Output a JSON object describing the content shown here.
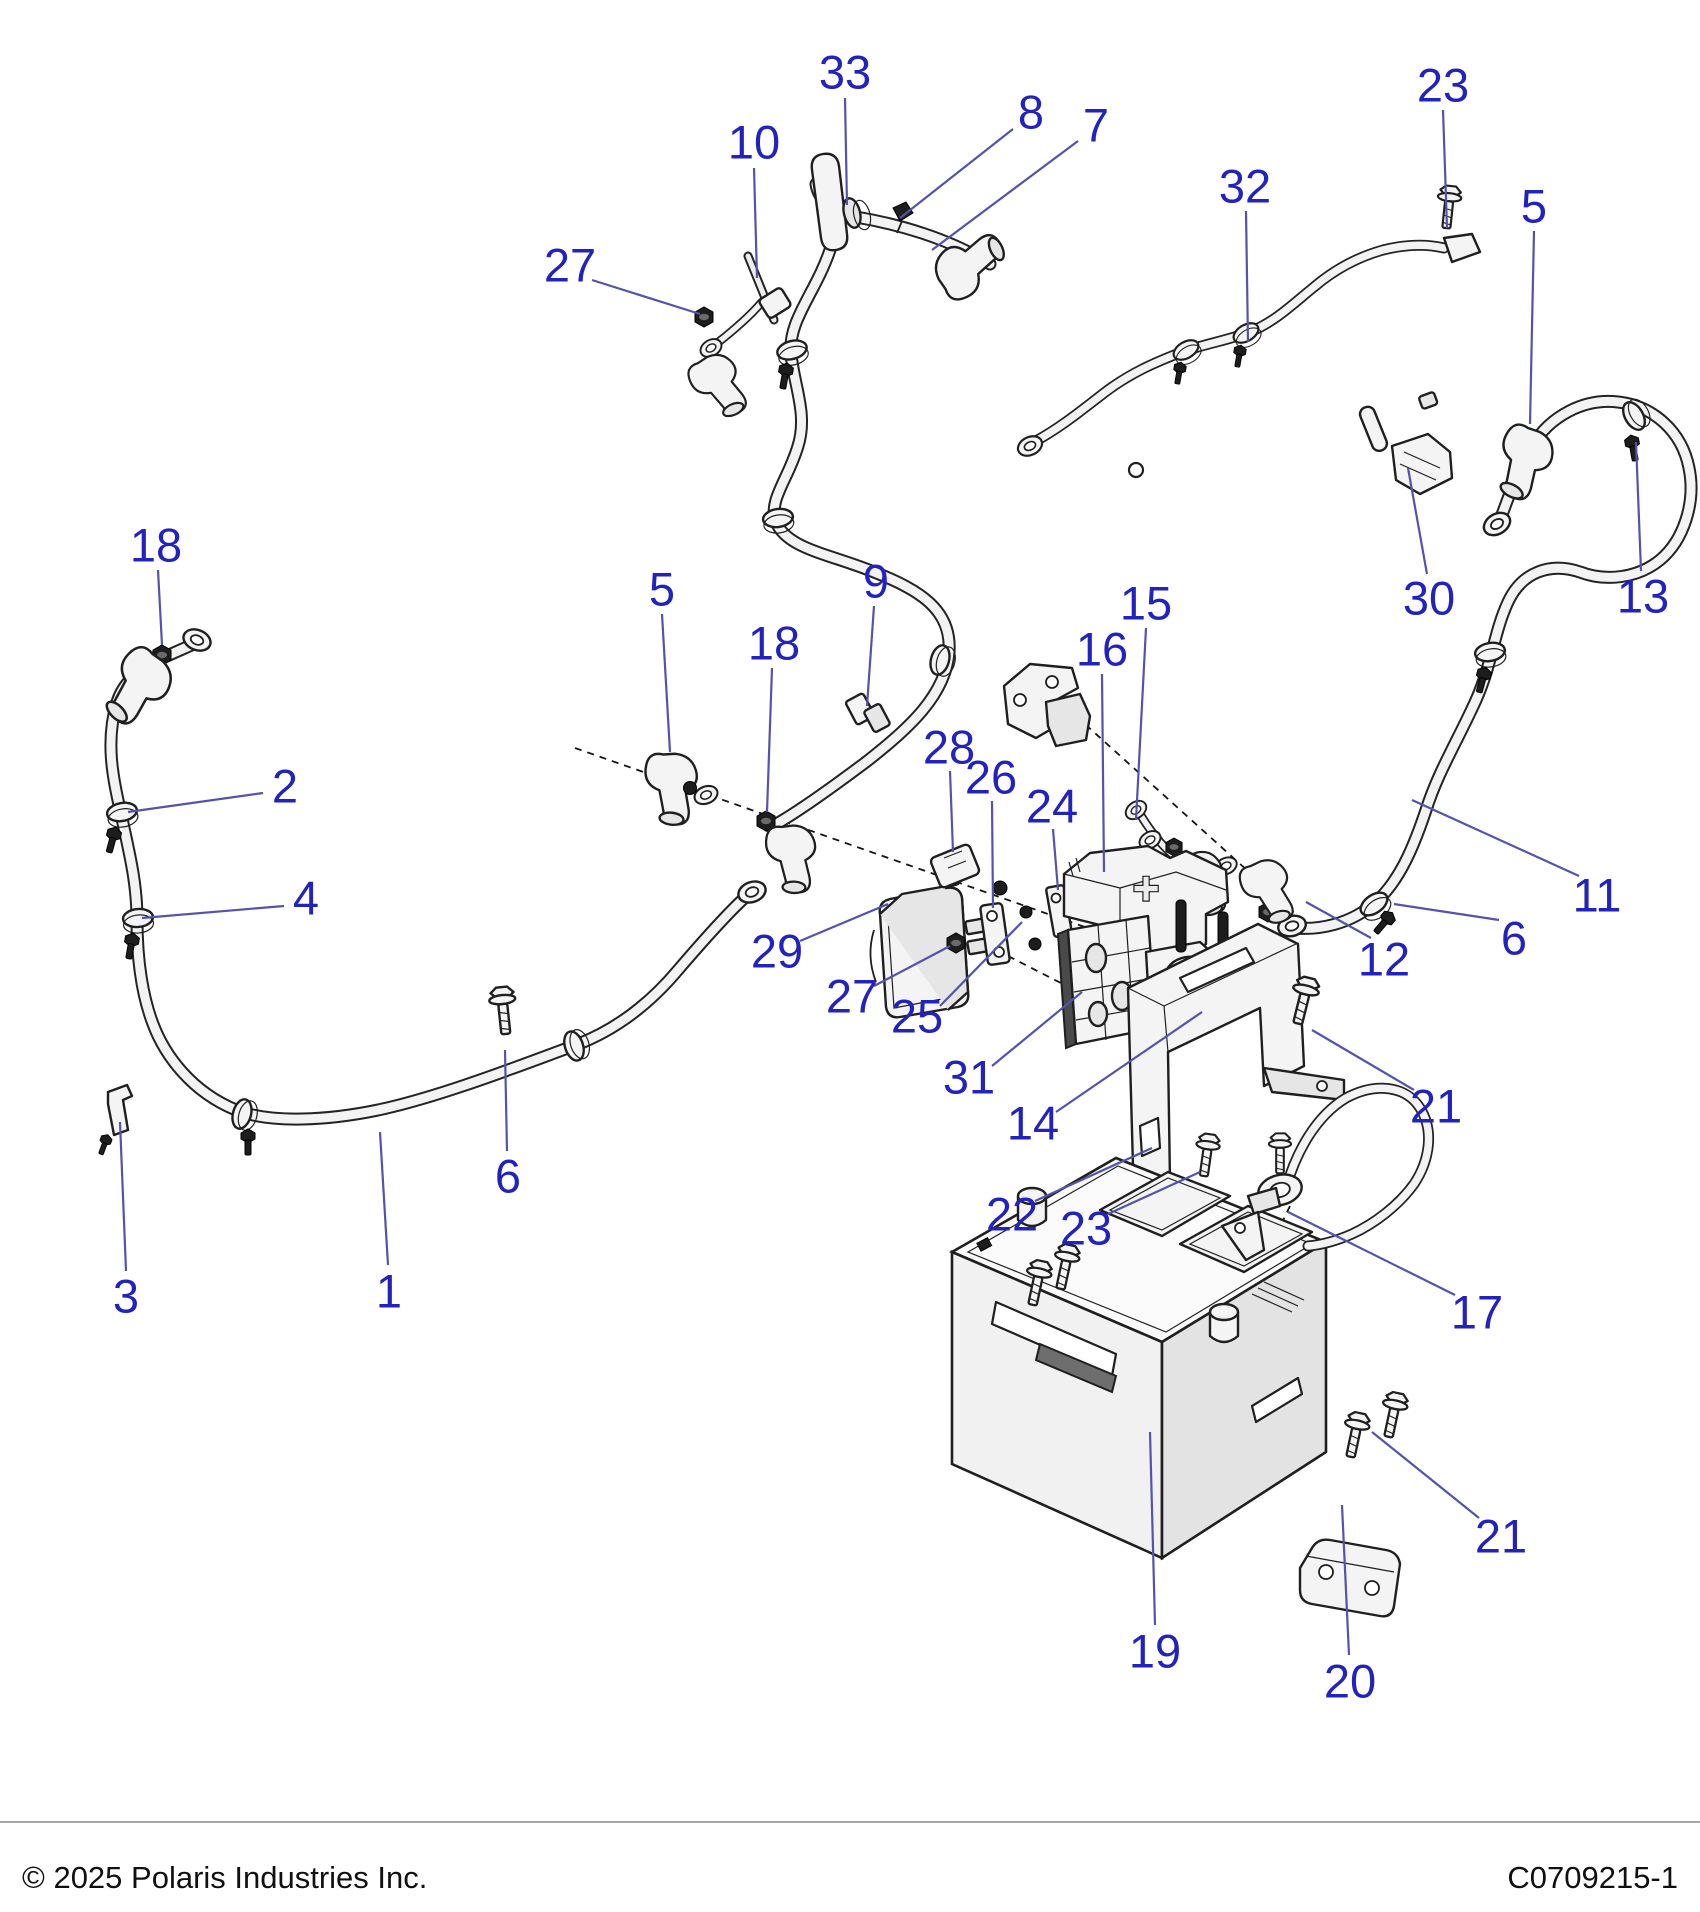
{
  "footer": {
    "copyright": "© 2025 Polaris Industries Inc.",
    "document_code": "C0709215-1"
  },
  "colors": {
    "callout_blue": "#2222bd",
    "leader_blue": "#5353ae",
    "line_black": "#1f1f1f",
    "part_fill": "#f4f4f4",
    "background": "#ffffff"
  },
  "parts": {
    "battery_cover_symbol": "+"
  },
  "callouts": [
    {
      "ref": "33",
      "x": 845,
      "y": 72,
      "leader": [
        845,
        98,
        847,
        205
      ]
    },
    {
      "ref": "10",
      "x": 754,
      "y": 142,
      "leader": [
        754,
        168,
        757,
        278
      ]
    },
    {
      "ref": "8",
      "x": 1031,
      "y": 112,
      "leader": [
        1013,
        129,
        900,
        218
      ]
    },
    {
      "ref": "7",
      "x": 1096,
      "y": 125,
      "leader": [
        1078,
        141,
        932,
        250
      ]
    },
    {
      "ref": "27",
      "x": 570,
      "y": 265,
      "leader": [
        592,
        280,
        700,
        314
      ]
    },
    {
      "ref": "23",
      "x": 1443,
      "y": 85,
      "leader": [
        1443,
        110,
        1447,
        228
      ]
    },
    {
      "ref": "32",
      "x": 1245,
      "y": 186,
      "leader": [
        1246,
        211,
        1248,
        342
      ]
    },
    {
      "ref": "5",
      "x": 1534,
      "y": 206,
      "leader": [
        1534,
        231,
        1530,
        424
      ]
    },
    {
      "ref": "18",
      "x": 156,
      "y": 545,
      "leader": [
        158,
        570,
        162,
        645
      ]
    },
    {
      "ref": "5",
      "x": 662,
      "y": 589,
      "leader": [
        662,
        614,
        670,
        752
      ]
    },
    {
      "ref": "9",
      "x": 876,
      "y": 581,
      "leader": [
        874,
        606,
        867,
        706
      ]
    },
    {
      "ref": "18",
      "x": 774,
      "y": 643,
      "leader": [
        772,
        668,
        767,
        812
      ]
    },
    {
      "ref": "15",
      "x": 1146,
      "y": 603,
      "leader": [
        1146,
        628,
        1136,
        820
      ]
    },
    {
      "ref": "16",
      "x": 1102,
      "y": 649,
      "leader": [
        1102,
        674,
        1104,
        872
      ]
    },
    {
      "ref": "30",
      "x": 1429,
      "y": 598,
      "leader": [
        1427,
        574,
        1408,
        468
      ]
    },
    {
      "ref": "13",
      "x": 1643,
      "y": 596,
      "leader": [
        1641,
        571,
        1636,
        442
      ]
    },
    {
      "ref": "28",
      "x": 949,
      "y": 747,
      "leader": [
        950,
        771,
        953,
        852
      ]
    },
    {
      "ref": "26",
      "x": 991,
      "y": 777,
      "leader": [
        992,
        801,
        993,
        908
      ]
    },
    {
      "ref": "24",
      "x": 1052,
      "y": 806,
      "leader": [
        1053,
        829,
        1058,
        890
      ]
    },
    {
      "ref": "2",
      "x": 285,
      "y": 786,
      "leader": [
        263,
        793,
        128,
        812
      ]
    },
    {
      "ref": "4",
      "x": 306,
      "y": 898,
      "leader": [
        284,
        906,
        142,
        918
      ]
    },
    {
      "ref": "29",
      "x": 777,
      "y": 951,
      "leader": [
        800,
        941,
        888,
        904
      ]
    },
    {
      "ref": "27",
      "x": 852,
      "y": 996,
      "leader": [
        874,
        986,
        950,
        946
      ]
    },
    {
      "ref": "25",
      "x": 917,
      "y": 1016,
      "leader": [
        940,
        1006,
        1022,
        922
      ]
    },
    {
      "ref": "31",
      "x": 969,
      "y": 1077,
      "leader": [
        992,
        1066,
        1082,
        992
      ]
    },
    {
      "ref": "14",
      "x": 1033,
      "y": 1123,
      "leader": [
        1056,
        1112,
        1202,
        1012
      ]
    },
    {
      "ref": "12",
      "x": 1384,
      "y": 959,
      "leader": [
        1371,
        938,
        1306,
        902
      ]
    },
    {
      "ref": "6",
      "x": 1514,
      "y": 938,
      "leader": [
        1499,
        920,
        1394,
        904
      ]
    },
    {
      "ref": "11",
      "x": 1597,
      "y": 895,
      "leader": [
        1579,
        876,
        1412,
        800
      ]
    },
    {
      "ref": "21",
      "x": 1436,
      "y": 1106,
      "leader": [
        1414,
        1090,
        1312,
        1030
      ]
    },
    {
      "ref": "22",
      "x": 1012,
      "y": 1214,
      "leader": [
        1035,
        1201,
        1152,
        1148
      ]
    },
    {
      "ref": "23",
      "x": 1086,
      "y": 1228,
      "leader": [
        1108,
        1214,
        1200,
        1172
      ]
    },
    {
      "ref": "17",
      "x": 1477,
      "y": 1312,
      "leader": [
        1455,
        1295,
        1288,
        1212
      ]
    },
    {
      "ref": "3",
      "x": 126,
      "y": 1296,
      "leader": [
        126,
        1271,
        120,
        1122
      ]
    },
    {
      "ref": "6",
      "x": 508,
      "y": 1176,
      "leader": [
        507,
        1151,
        505,
        1050
      ]
    },
    {
      "ref": "1",
      "x": 389,
      "y": 1291,
      "leader": [
        388,
        1265,
        380,
        1132
      ]
    },
    {
      "ref": "19",
      "x": 1155,
      "y": 1651,
      "leader": [
        1155,
        1625,
        1150,
        1432
      ]
    },
    {
      "ref": "20",
      "x": 1350,
      "y": 1681,
      "leader": [
        1349,
        1655,
        1342,
        1505
      ]
    },
    {
      "ref": "21",
      "x": 1501,
      "y": 1536,
      "leader": [
        1479,
        1518,
        1372,
        1432
      ]
    }
  ]
}
